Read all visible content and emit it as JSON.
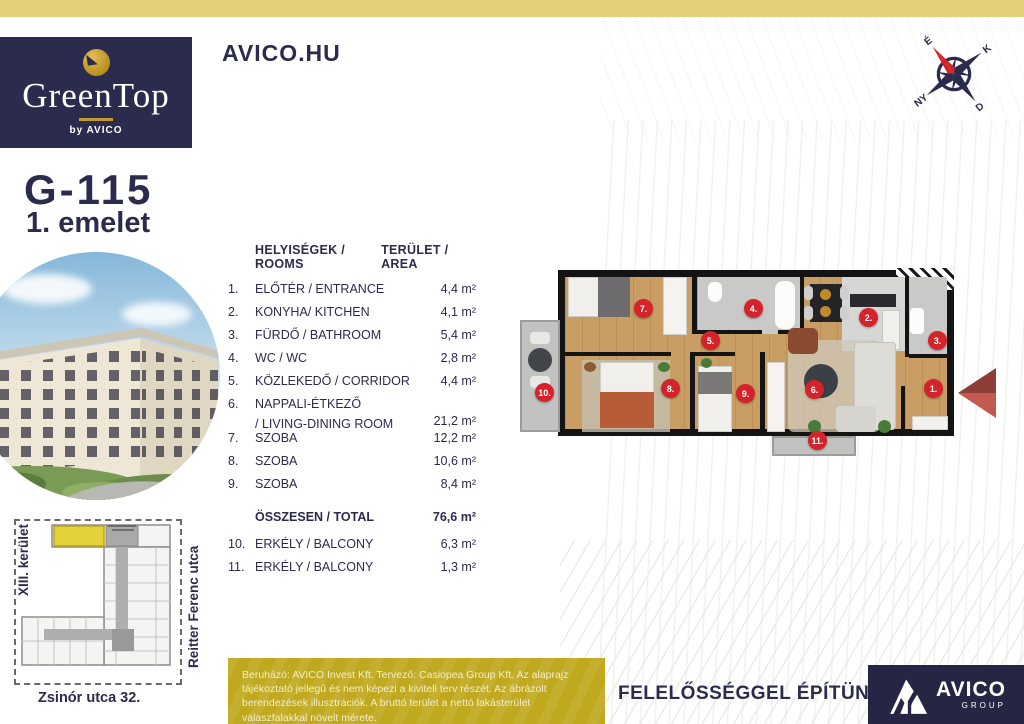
{
  "colors": {
    "navy": "#2b2b4e",
    "gold_band": "#e5cf7b",
    "logo_gold": "#c49a2c",
    "marker_red": "#d5232b",
    "disclaimer_yellow": "#c0a91f",
    "wood_floor": "#c99e64",
    "siteplan_highlight": "#e5d23a"
  },
  "header": {
    "brand_name": "GreenTop",
    "brand_by": "by AVICO",
    "site_link": "AVICO.HU",
    "compass": {
      "n": "É",
      "e": "K",
      "s": "D",
      "w": "NY"
    }
  },
  "unit": {
    "id": "G-115",
    "floor": "1. emelet"
  },
  "table": {
    "col_rooms": "HELYISÉGEK / ROOMS",
    "col_area": "TERÜLET / AREA",
    "rows": [
      {
        "num": "1.",
        "name": "ELŐTÉR / ENTRANCE",
        "area": "4,4 m²"
      },
      {
        "num": "2.",
        "name": "KONYHA/ KITCHEN",
        "area": "4,1 m²"
      },
      {
        "num": "3.",
        "name": "FÜRDŐ / BATHROOM",
        "area": "5,4 m²"
      },
      {
        "num": "4.",
        "name": "WC / WC",
        "area": "2,8 m²"
      },
      {
        "num": "5.",
        "name": "KÖZLEKEDŐ / CORRIDOR",
        "area": "4,4 m²"
      },
      {
        "num": "6.",
        "name": "NAPPALI-ÉTKEZŐ",
        "name2": "/ LIVING-DINING ROOM",
        "area": "21,2 m²"
      },
      {
        "num": "7.",
        "name": "SZOBA",
        "area": "12,2 m²"
      },
      {
        "num": "8.",
        "name": "SZOBA",
        "area": "10,6 m²"
      },
      {
        "num": "9.",
        "name": "SZOBA",
        "area": "8,4 m²"
      }
    ],
    "total": {
      "label": "ÖSSZESEN / TOTAL",
      "area": "76,6 m²"
    },
    "extra_rows": [
      {
        "num": "10.",
        "name": "ERKÉLY / BALCONY",
        "area": "6,3 m²"
      },
      {
        "num": "11.",
        "name": "ERKÉLY / BALCONY",
        "area": "1,3 m²"
      }
    ]
  },
  "floorplan": {
    "markers": [
      {
        "n": "7.",
        "x": 123,
        "y": 40
      },
      {
        "n": "4.",
        "x": 233,
        "y": 40
      },
      {
        "n": "2.",
        "x": 348,
        "y": 49
      },
      {
        "n": "5.",
        "x": 190,
        "y": 72
      },
      {
        "n": "3.",
        "x": 417,
        "y": 72
      },
      {
        "n": "10.",
        "x": 24,
        "y": 124
      },
      {
        "n": "8.",
        "x": 150,
        "y": 120
      },
      {
        "n": "9.",
        "x": 225,
        "y": 125
      },
      {
        "n": "6.",
        "x": 294,
        "y": 121
      },
      {
        "n": "1.",
        "x": 413,
        "y": 120
      },
      {
        "n": "11.",
        "x": 297,
        "y": 172
      }
    ]
  },
  "siteplan": {
    "district": "XIII. kerület",
    "street_right": "Reitter Ferenc utca",
    "address": "Zsinór utca 32."
  },
  "footer": {
    "disclaimer": "Beruházó: AVICO Invest Kft. Tervező: Casiopea Group Kft. Az alaprajz tájékoztató jellegű és nem képezi a kiviteli terv részét. Az ábrázolt berendezések illusztrációk. A bruttó terület a nettó lakásterület válaszfalakkal növelt mérete.",
    "slogan": "FELELŐSSÉGGEL ÉPÍTÜNK",
    "group_name": "AVICO",
    "group_sub": "GROUP"
  }
}
